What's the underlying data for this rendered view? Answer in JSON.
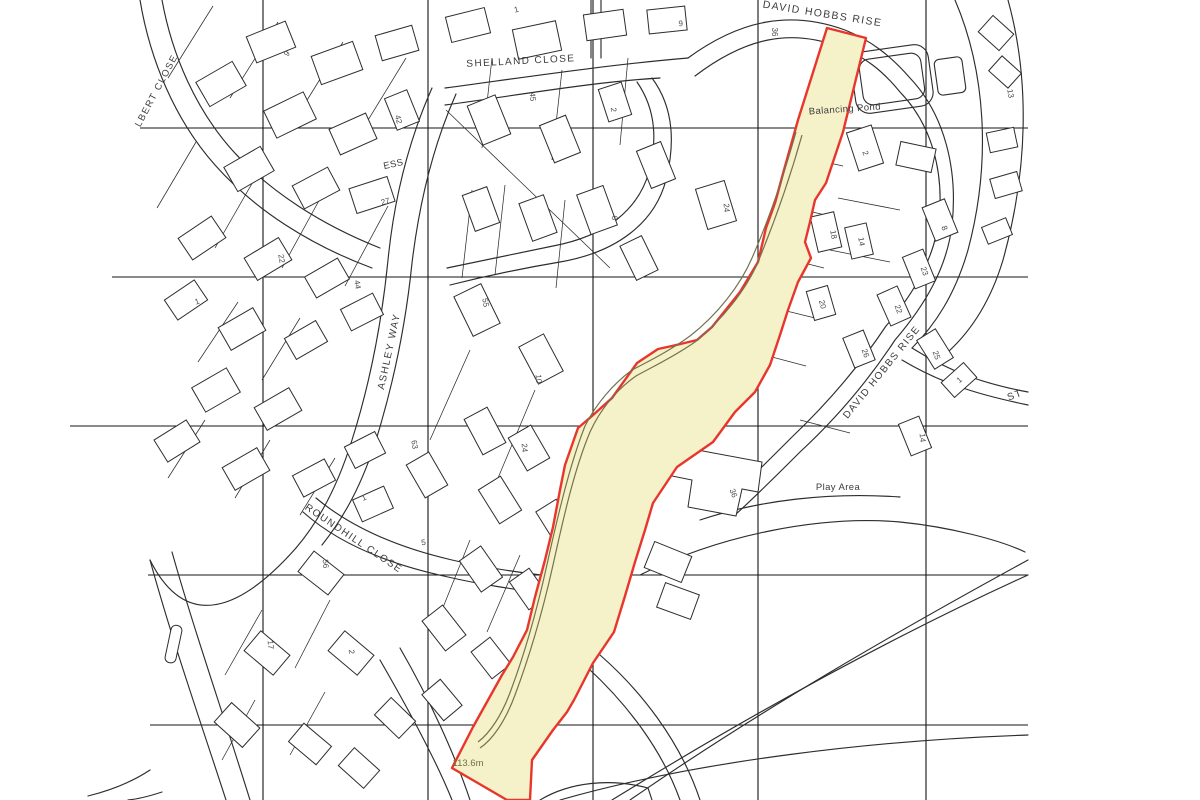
{
  "map": {
    "kind": "site-location-plan",
    "colors": {
      "site_fill": "#f5f2ca",
      "site_outline": "#e8362d",
      "track": "#73734d",
      "map_ink": "#2d2d2d",
      "grid": "#141414",
      "label_ink": "#3c3c3c",
      "number_ink": "#4b4b4b",
      "spot_height_ink": "#6e6e49"
    },
    "street_labels": [
      {
        "text": "DAVID HOBBS RISE",
        "x": 822,
        "y": 17,
        "rotate": 9,
        "size": 10.5
      },
      {
        "text": "SHELLAND CLOSE",
        "x": 521,
        "y": 64,
        "rotate": -3,
        "size": 10
      },
      {
        "text": "ASHLEY WAY",
        "x": 392,
        "y": 352,
        "rotate": -78,
        "size": 10
      },
      {
        "text": "ROUNDHILL CLOSE",
        "x": 352,
        "y": 541,
        "rotate": 34,
        "size": 10
      },
      {
        "text": "DAVID HOBBS RISE",
        "x": 884,
        "y": 374,
        "rotate": -51,
        "size": 10
      },
      {
        "text": "ST",
        "x": 1016,
        "y": 398,
        "rotate": -20,
        "size": 10
      },
      {
        "text": "LBERT CLOSE",
        "x": 159,
        "y": 92,
        "rotate": -62,
        "size": 9.5
      }
    ],
    "area_labels": [
      {
        "text": "Balancing Pond",
        "x": 845,
        "y": 112,
        "rotate": -4
      },
      {
        "text": "Play Area",
        "x": 838,
        "y": 490,
        "rotate": 0
      },
      {
        "text": "ESS",
        "x": 394,
        "y": 167,
        "rotate": -12
      }
    ],
    "spot_heights": [
      {
        "text": "113.6m",
        "x": 468,
        "y": 766
      }
    ],
    "house_numbers": [
      {
        "text": "1",
        "x": 517,
        "y": 12,
        "rotate": -15
      },
      {
        "text": "9",
        "x": 681,
        "y": 26,
        "rotate": -5
      },
      {
        "text": "36",
        "x": 772,
        "y": 32,
        "rotate": 90
      },
      {
        "text": "13",
        "x": 1008,
        "y": 94,
        "rotate": 80
      },
      {
        "text": "9",
        "x": 289,
        "y": 55,
        "rotate": -55
      },
      {
        "text": "42",
        "x": 396,
        "y": 120,
        "rotate": 75
      },
      {
        "text": "27",
        "x": 386,
        "y": 204,
        "rotate": -15
      },
      {
        "text": "22",
        "x": 279,
        "y": 259,
        "rotate": 80
      },
      {
        "text": "44",
        "x": 355,
        "y": 285,
        "rotate": 80
      },
      {
        "text": "1",
        "x": 198,
        "y": 304,
        "rotate": -20
      },
      {
        "text": "45",
        "x": 530,
        "y": 97,
        "rotate": 85
      },
      {
        "text": "2",
        "x": 611,
        "y": 110,
        "rotate": 85
      },
      {
        "text": "6",
        "x": 612,
        "y": 218,
        "rotate": 85
      },
      {
        "text": "24",
        "x": 724,
        "y": 208,
        "rotate": 85
      },
      {
        "text": "55",
        "x": 483,
        "y": 303,
        "rotate": 80
      },
      {
        "text": "10",
        "x": 536,
        "y": 379,
        "rotate": 85
      },
      {
        "text": "2",
        "x": 863,
        "y": 154,
        "rotate": 70
      },
      {
        "text": "18",
        "x": 831,
        "y": 235,
        "rotate": 80
      },
      {
        "text": "14",
        "x": 859,
        "y": 242,
        "rotate": 80
      },
      {
        "text": "8",
        "x": 942,
        "y": 229,
        "rotate": 70
      },
      {
        "text": "23",
        "x": 922,
        "y": 272,
        "rotate": 70
      },
      {
        "text": "22",
        "x": 896,
        "y": 310,
        "rotate": 70
      },
      {
        "text": "20",
        "x": 820,
        "y": 305,
        "rotate": 75
      },
      {
        "text": "26",
        "x": 863,
        "y": 354,
        "rotate": 70
      },
      {
        "text": "25",
        "x": 934,
        "y": 356,
        "rotate": 70
      },
      {
        "text": "1",
        "x": 961,
        "y": 382,
        "rotate": -40
      },
      {
        "text": "14",
        "x": 920,
        "y": 438,
        "rotate": 85
      },
      {
        "text": "63",
        "x": 412,
        "y": 445,
        "rotate": 80
      },
      {
        "text": "24",
        "x": 522,
        "y": 448,
        "rotate": 85
      },
      {
        "text": "36",
        "x": 731,
        "y": 494,
        "rotate": 70
      },
      {
        "text": "1",
        "x": 365,
        "y": 500,
        "rotate": -25
      },
      {
        "text": "5",
        "x": 424,
        "y": 545,
        "rotate": -10
      },
      {
        "text": "56",
        "x": 323,
        "y": 564,
        "rotate": 85
      },
      {
        "text": "17",
        "x": 268,
        "y": 645,
        "rotate": 85
      },
      {
        "text": "2",
        "x": 349,
        "y": 652,
        "rotate": 85
      }
    ]
  }
}
